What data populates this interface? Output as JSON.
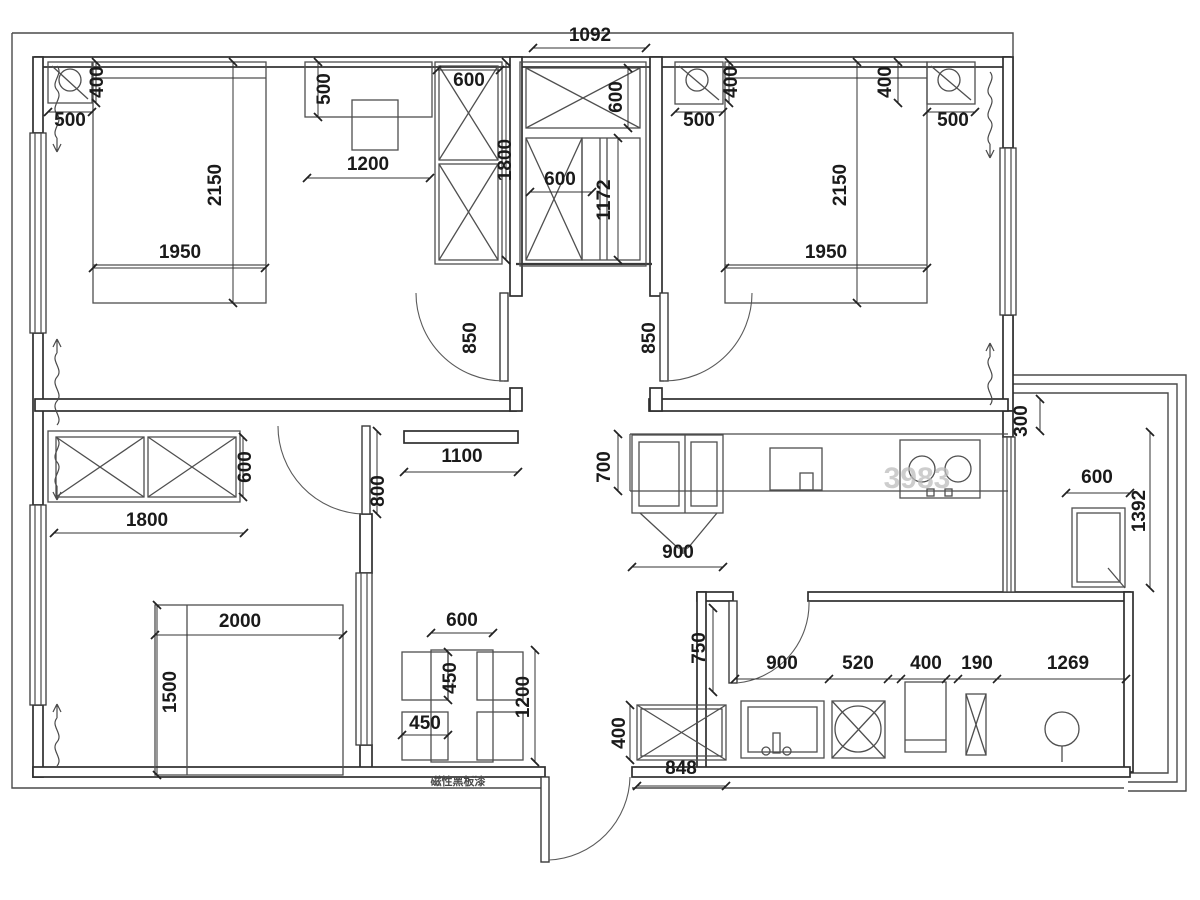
{
  "document": {
    "kind": "apartment-floor-plan",
    "units": "mm"
  },
  "annotations": {
    "wall_note": "磁性黑板漆",
    "watermark": "3983"
  },
  "dimension_labels": [
    {
      "text": "400",
      "x": 103,
      "y": 82,
      "rot": 1
    },
    {
      "text": "500",
      "x": 70,
      "y": 126
    },
    {
      "text": "2150",
      "x": 221,
      "y": 185,
      "rot": 1
    },
    {
      "text": "1950",
      "x": 180,
      "y": 258
    },
    {
      "text": "500",
      "x": 330,
      "y": 89,
      "rot": 1
    },
    {
      "text": "1200",
      "x": 368,
      "y": 170
    },
    {
      "text": "600",
      "x": 469,
      "y": 86
    },
    {
      "text": "1800",
      "x": 511,
      "y": 160,
      "rot": 1
    },
    {
      "text": "1092",
      "x": 590,
      "y": 41
    },
    {
      "text": "600",
      "x": 622,
      "y": 97,
      "rot": 1
    },
    {
      "text": "600",
      "x": 560,
      "y": 185
    },
    {
      "text": "1172",
      "x": 610,
      "y": 200,
      "rot": 1
    },
    {
      "text": "850",
      "x": 476,
      "y": 338,
      "rot": 1
    },
    {
      "text": "850",
      "x": 655,
      "y": 338,
      "rot": 1
    },
    {
      "text": "400",
      "x": 737,
      "y": 82,
      "rot": 1
    },
    {
      "text": "500",
      "x": 699,
      "y": 126
    },
    {
      "text": "2150",
      "x": 846,
      "y": 185,
      "rot": 1
    },
    {
      "text": "1950",
      "x": 826,
      "y": 258
    },
    {
      "text": "400",
      "x": 891,
      "y": 82,
      "rot": 1
    },
    {
      "text": "500",
      "x": 953,
      "y": 126
    },
    {
      "text": "600",
      "x": 251,
      "y": 467,
      "rot": 1
    },
    {
      "text": "1800",
      "x": 147,
      "y": 526
    },
    {
      "text": "800",
      "x": 384,
      "y": 491,
      "rot": 1
    },
    {
      "text": "1100",
      "x": 462,
      "y": 462
    },
    {
      "text": "2000",
      "x": 240,
      "y": 627
    },
    {
      "text": "1500",
      "x": 176,
      "y": 692,
      "rot": 1
    },
    {
      "text": "600",
      "x": 462,
      "y": 626
    },
    {
      "text": "450",
      "x": 456,
      "y": 678,
      "rot": 1
    },
    {
      "text": "450",
      "x": 425,
      "y": 729
    },
    {
      "text": "1200",
      "x": 529,
      "y": 697,
      "rot": 1
    },
    {
      "text": "700",
      "x": 610,
      "y": 467,
      "rot": 1
    },
    {
      "text": "900",
      "x": 678,
      "y": 558
    },
    {
      "text": "300",
      "x": 1027,
      "y": 421,
      "rot": 1
    },
    {
      "text": "600",
      "x": 1097,
      "y": 483
    },
    {
      "text": "1392",
      "x": 1145,
      "y": 511,
      "rot": 1
    },
    {
      "text": "750",
      "x": 705,
      "y": 648,
      "rot": 1
    },
    {
      "text": "900",
      "x": 782,
      "y": 669
    },
    {
      "text": "520",
      "x": 858,
      "y": 669
    },
    {
      "text": "400",
      "x": 926,
      "y": 669
    },
    {
      "text": "190",
      "x": 977,
      "y": 669
    },
    {
      "text": "1269",
      "x": 1068,
      "y": 669
    },
    {
      "text": "400",
      "x": 625,
      "y": 733,
      "rot": 1
    },
    {
      "text": "848",
      "x": 681,
      "y": 774
    }
  ],
  "special_labels": [
    {
      "id": "wall-note",
      "text": "磁性黑板漆",
      "x": 458,
      "y": 785,
      "size": 11,
      "color": "#4a4a4a"
    },
    {
      "id": "watermark",
      "text": "3983",
      "x": 917,
      "y": 488,
      "size": 30,
      "color": "#bdbdbd",
      "opacity": 0.75
    }
  ]
}
